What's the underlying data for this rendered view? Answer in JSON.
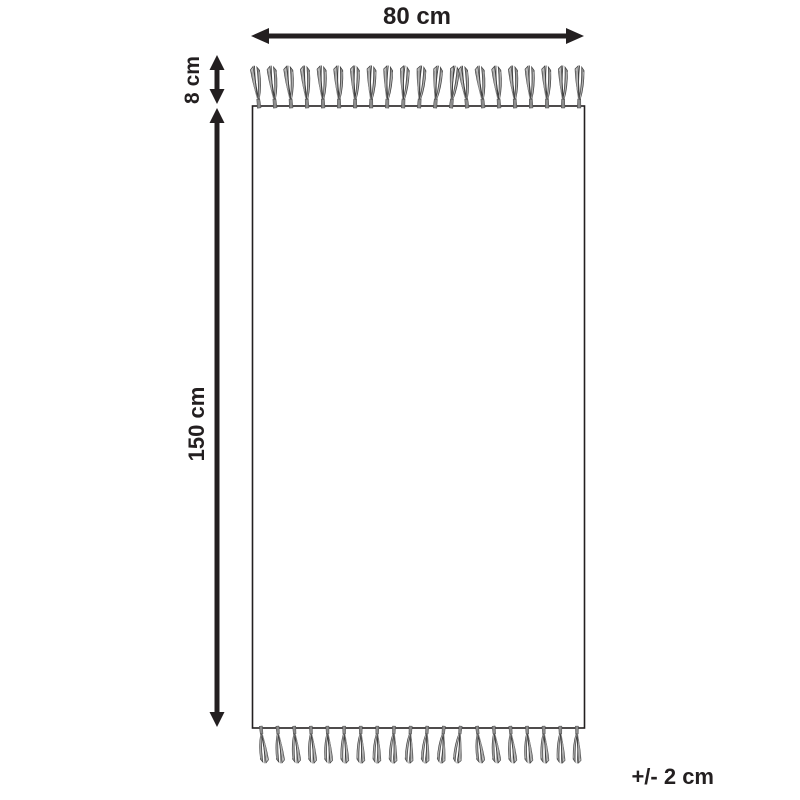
{
  "diagram": {
    "labels": {
      "width": "80 cm",
      "fringe": "8 cm",
      "length": "150 cm",
      "tolerance": "+/- 2 cm"
    },
    "colors": {
      "ink": "#231f20",
      "background": "#ffffff",
      "tassel_light": "#b9b9b9",
      "tassel_mid": "#8c8c8c",
      "tassel_dark": "#3f3f3f"
    },
    "tassels": {
      "top_count": 21,
      "bottom_count": 20
    }
  }
}
